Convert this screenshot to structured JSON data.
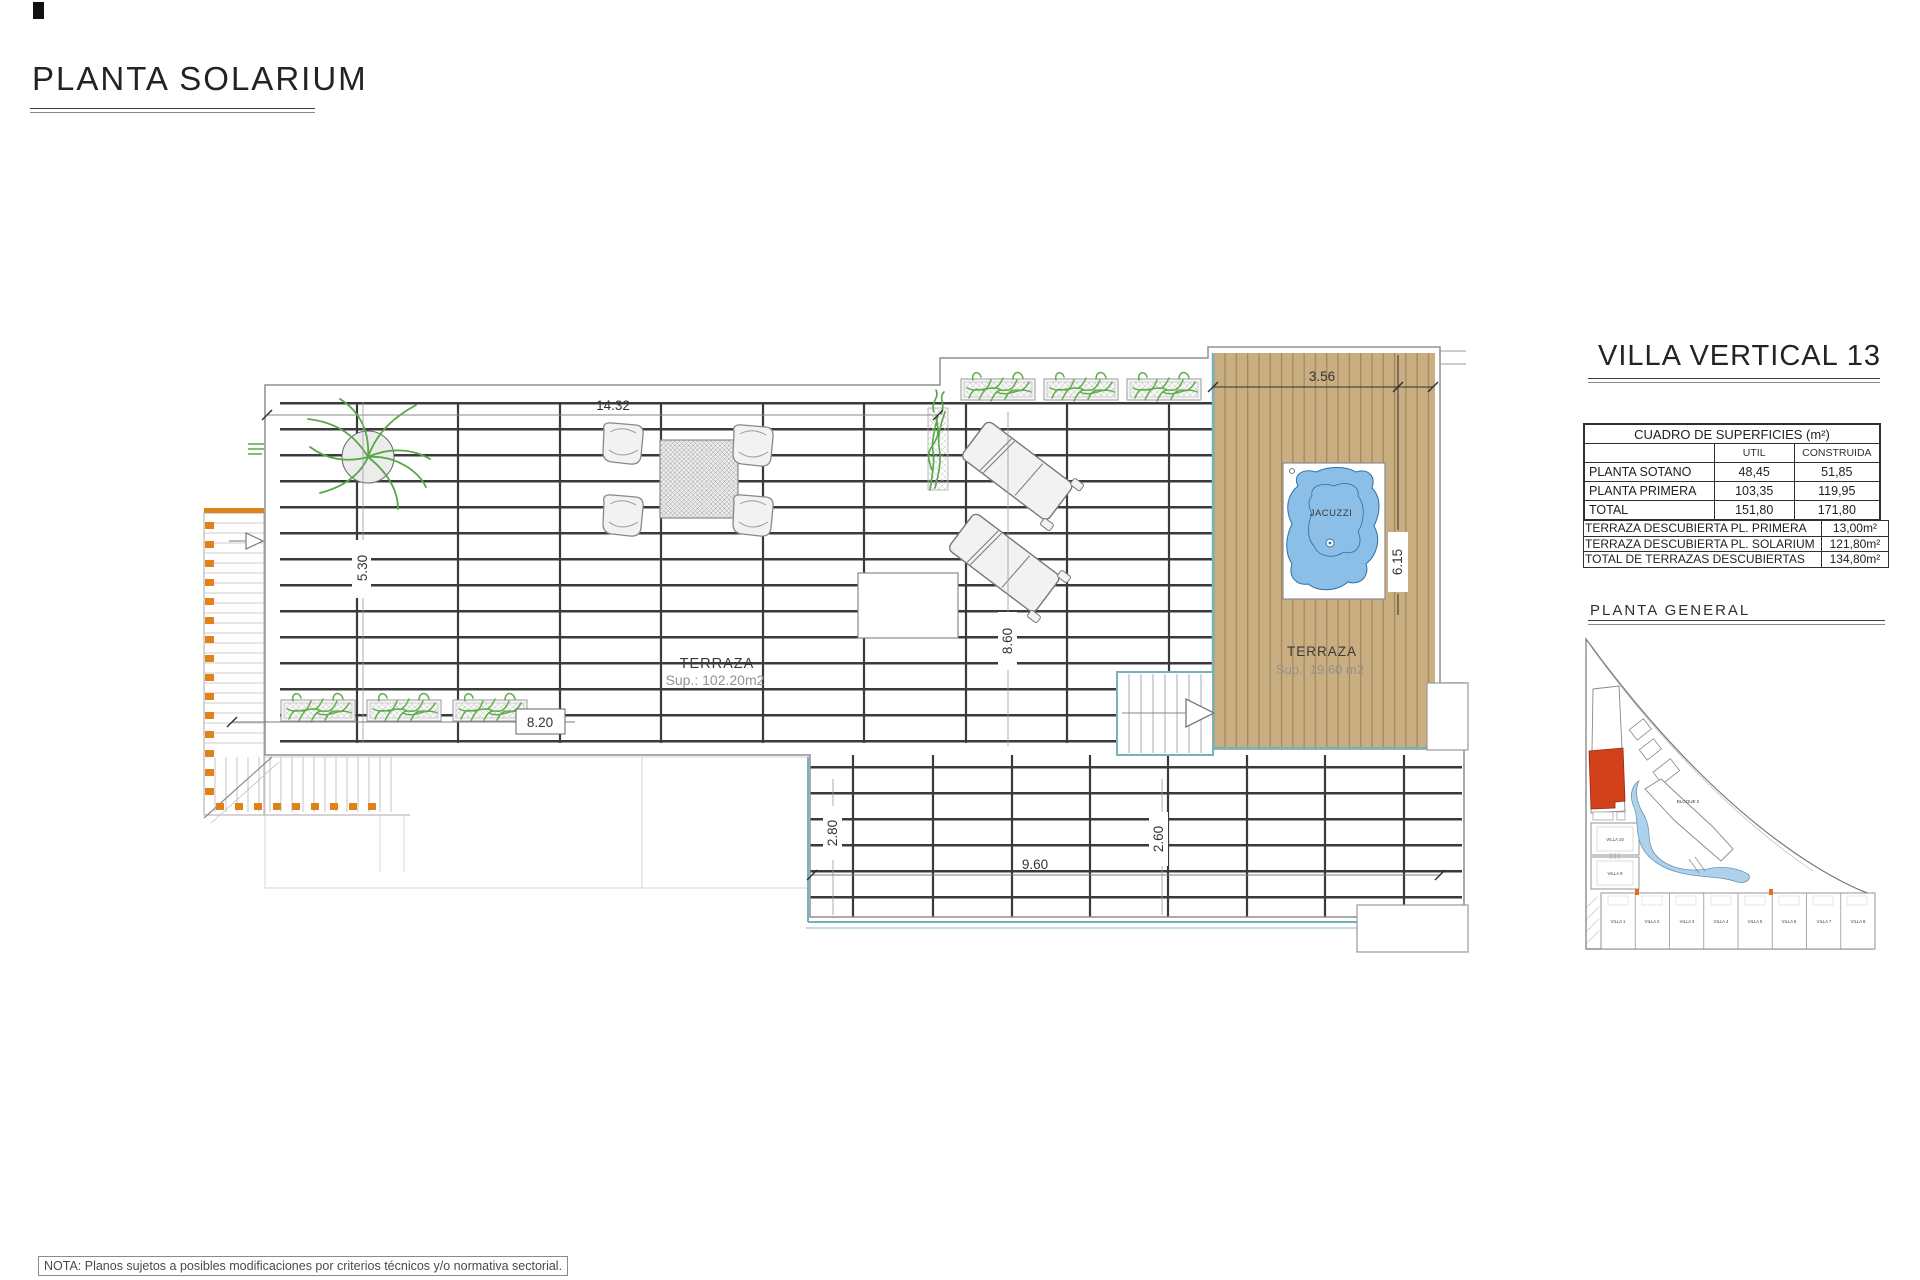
{
  "page": {
    "title": "PLANTA SOLARIUM",
    "note": "NOTA: Planos sujetos a posibles modificaciones por criterios técnicos y/o normativa sectorial."
  },
  "panel": {
    "title": "VILLA VERTICAL 13",
    "surfaces": {
      "title": "CUADRO DE SUPERFICIES (m²)",
      "columns": {
        "util": "UTIL",
        "construida": "CONSTRUIDA"
      },
      "rows": [
        {
          "label": "PLANTA SOTANO",
          "util": "48,45",
          "construida": "51,85"
        },
        {
          "label": "PLANTA PRIMERA",
          "util": "103,35",
          "construida": "119,95"
        },
        {
          "label": "TOTAL",
          "util": "151,80",
          "construida": "171,80"
        }
      ]
    },
    "terraces": {
      "rows": [
        {
          "label": "TERRAZA DESCUBIERTA PL. PRIMERA",
          "value": "13,00m²"
        },
        {
          "label": "TERRAZA DESCUBIERTA PL. SOLARIUM",
          "value": "121,80m²"
        },
        {
          "label": "TOTAL DE TERRAZAS DESCUBIERTAS",
          "value": "134,80m²"
        }
      ]
    },
    "site_plan": {
      "title": "PLANTA GENERAL",
      "block_label": "BLOQUE 2",
      "villas": [
        "VILLA 1",
        "VILLA 2",
        "VILLA 3",
        "VILLA 4",
        "VILLA 5",
        "VILLA 6",
        "VILLA 7",
        "VILLA 8"
      ],
      "villa_9": "VILLA 9",
      "villa_10": "VILLA 10"
    }
  },
  "plan": {
    "terrace_main": {
      "label": "TERRAZA",
      "area": "Sup.: 102.20m2"
    },
    "terrace_deck": {
      "label": "TERRAZA",
      "area": "Sup.: 19.60  m2"
    },
    "jacuzzi_label": "JACUZZI",
    "dimensions": {
      "top_width": "14.32",
      "deck_width": "3.56",
      "left_height": "5.30",
      "planter_width": "8.20",
      "mid_height": "8.60",
      "deck_height": "6.15",
      "lower_left_height": "2.80",
      "lower_width": "9.60",
      "lower_right_height": "2.60"
    }
  },
  "colors": {
    "deck_wood": "#c9ae82",
    "deck_plank_line": "#a5885c",
    "water": "#8bbfe8",
    "teal_edge": "#74b3be",
    "stair_orange": "#e0821a",
    "plant_green": "#5fae49",
    "site_highlight": "#d3411b",
    "site_water": "#aed1ec"
  }
}
